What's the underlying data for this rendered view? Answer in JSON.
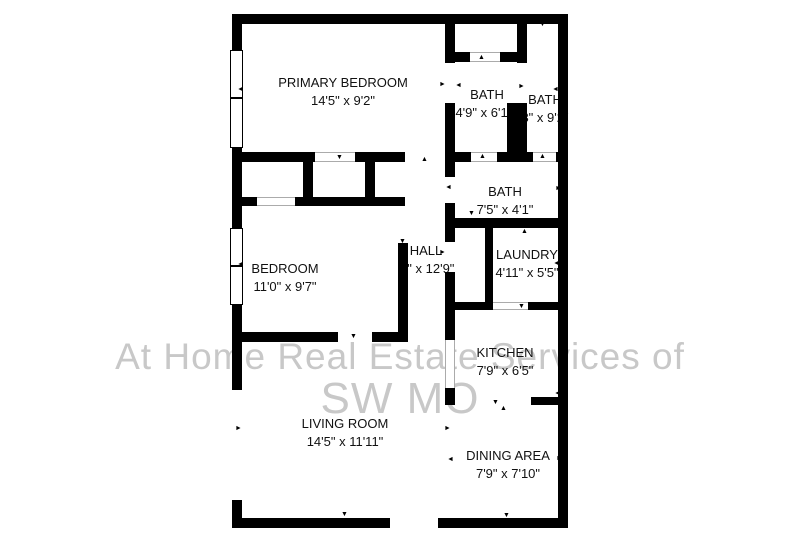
{
  "watermark": {
    "line1": "At Home Real Estate Services of",
    "line2": "SW MO",
    "color": "#c8c8c8"
  },
  "floorplan": {
    "background": "#ffffff",
    "wall_color": "#000000",
    "rooms": [
      {
        "name": "PRIMARY BEDROOM",
        "dims": "14'5\" x 9'2\""
      },
      {
        "name": "BATH",
        "dims": "4'9\" x 6'11\""
      },
      {
        "name": "BATH",
        "dims": "3\" x 9'2\""
      },
      {
        "name": "BATH",
        "dims": "7'5\" x 4'1\""
      },
      {
        "name": "HALL",
        "dims": "'1\" x 12'9\""
      },
      {
        "name": "BEDROOM",
        "dims": "11'0\" x 9'7\""
      },
      {
        "name": "LAUNDRY",
        "dims": "4'11\" x 5'5\""
      },
      {
        "name": "KITCHEN",
        "dims": "7'9\" x 6'5\""
      },
      {
        "name": "LIVING ROOM",
        "dims": "14'5\" x 11'11\""
      },
      {
        "name": "DINING AREA",
        "dims": "7'9\" x 7'10\""
      }
    ]
  }
}
